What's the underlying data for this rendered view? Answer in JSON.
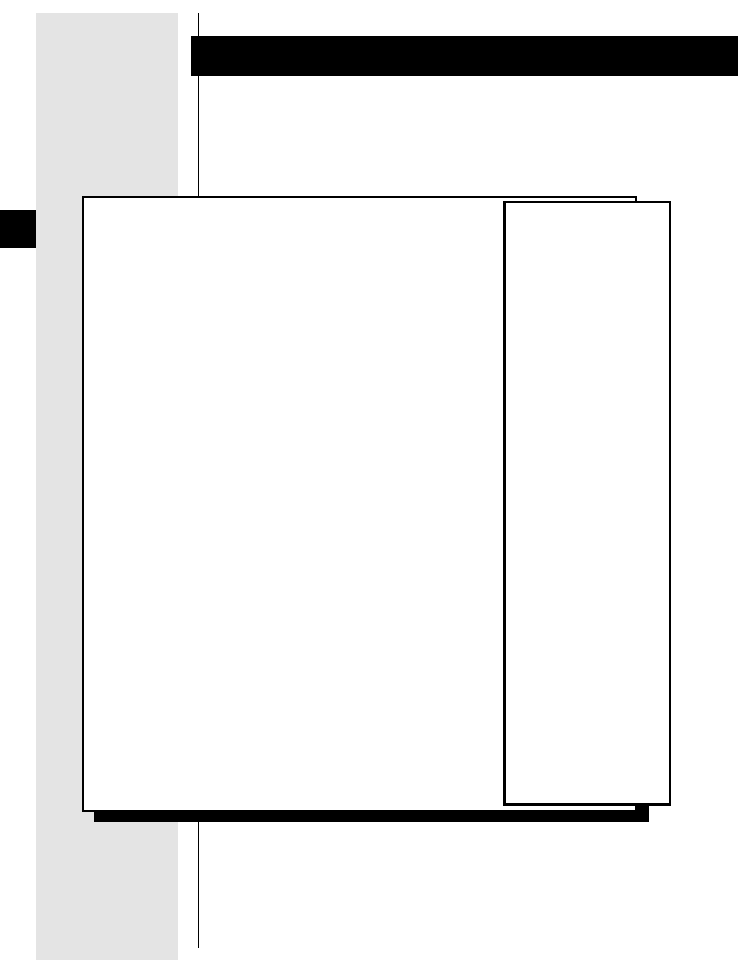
{
  "page": {
    "colors": {
      "background": "#ffffff",
      "ink": "#000000",
      "margin_band": "#e4e4e4",
      "panel_fill": "#ffffff"
    },
    "text_content": ""
  }
}
